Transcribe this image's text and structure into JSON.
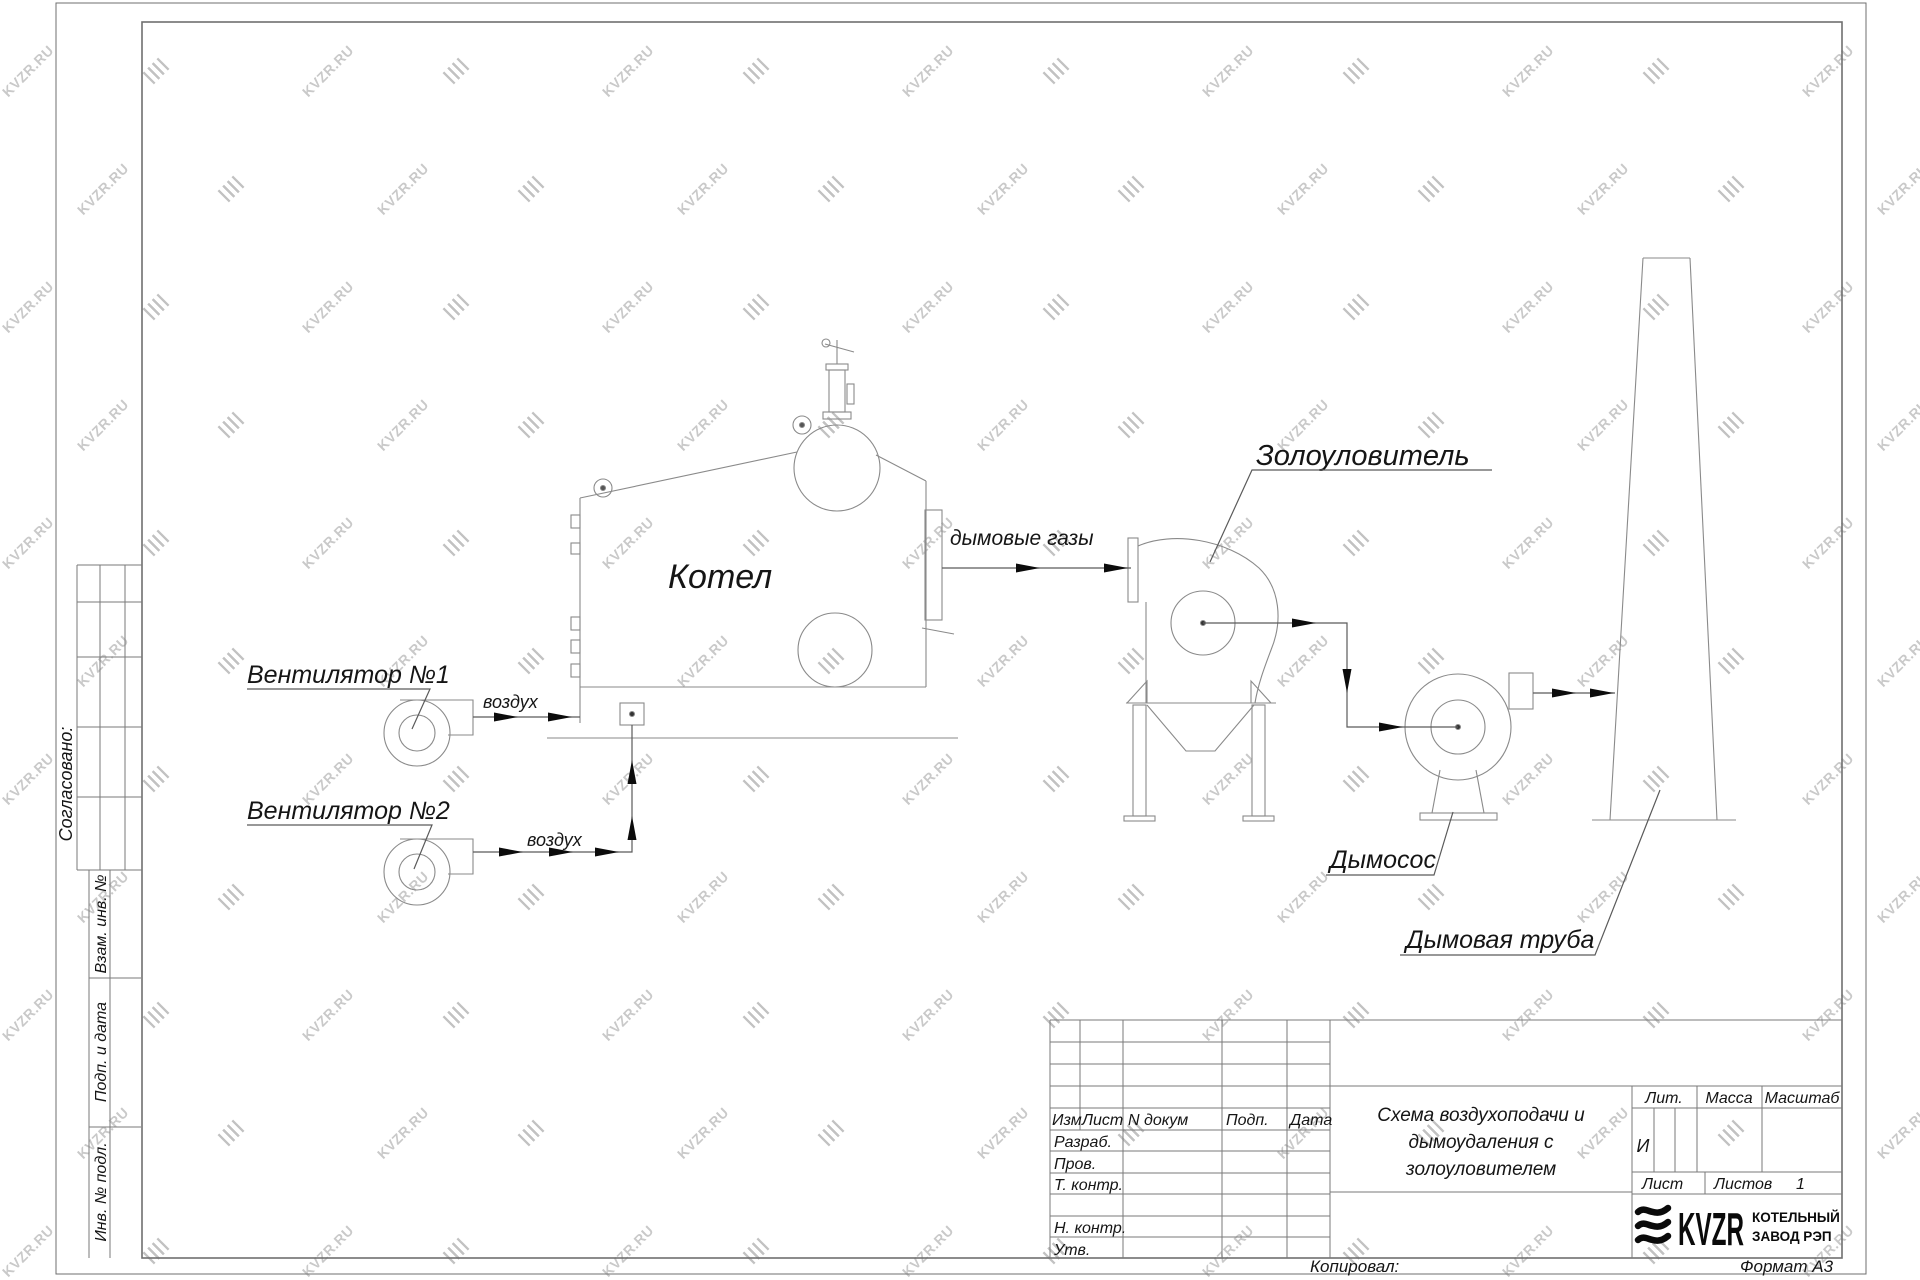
{
  "watermark": {
    "text": "KVZR.RU"
  },
  "colors": {
    "line": "#8a8a8a",
    "flow_line": "#5a5a5a",
    "arrowhead": "#0c0c0c",
    "text": "#151515",
    "watermark": "#c9c9c9",
    "logo": "#0a0a0a"
  },
  "diagram": {
    "labels": {
      "boiler": "Котел",
      "fan1": "Вентилятор №1",
      "fan2": "Вентилятор №2",
      "air": "воздух",
      "flue_gases": "дымовые газы",
      "ash_collector": "Золоуловитель",
      "smoke_exhauster": "Дымосос",
      "chimney": "Дымовая труба"
    },
    "icons": {
      "watermark_mark": "kvzr-stripes-icon",
      "logo_mark": "kvzr-logo-stripes"
    }
  },
  "side_columns": {
    "agreed": "Согласовано:",
    "vzam_inv": "Взам. инв. №",
    "podp_i_data": "Подп. и дата",
    "inv_podl": "Инв. № подл."
  },
  "title_block": {
    "header": {
      "izm": "Изм",
      "list": "Лист",
      "n_dokum": "N докум",
      "podp": "Подп.",
      "data": "Дата"
    },
    "signature_rows": [
      "Разраб.",
      "Пров.",
      "Т. контр.",
      "Н. контр.",
      "Утв."
    ],
    "name_lines": [
      "Схема воздухоподачи и",
      "дымоудаления с",
      "золоуловителем"
    ],
    "lit_label": "Лит.",
    "massa_label": "Масса",
    "masshtab_label": "Масштаб",
    "lit_value": "И",
    "list_label": "Лист",
    "listov_label": "Листов",
    "listov_value": "1",
    "logo_text": "KVZR",
    "logo_caption_line1": "КОТЕЛЬНЫЙ",
    "logo_caption_line2": "ЗАВОД РЭП"
  },
  "footer": {
    "copied": "Копировал:",
    "format": "Формат А3"
  }
}
